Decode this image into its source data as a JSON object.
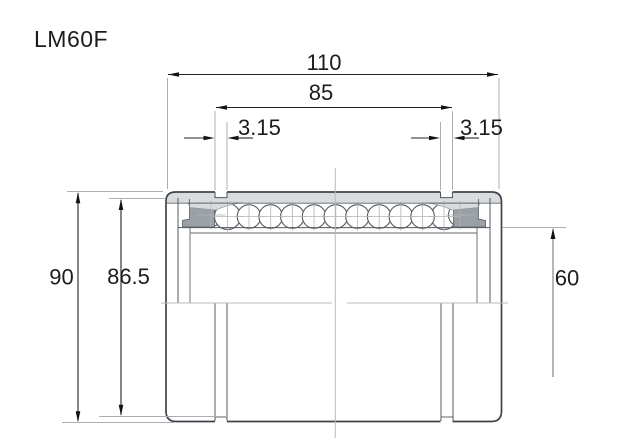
{
  "title": "LM60F",
  "dimensions": {
    "overall_length": "110",
    "groove_span": "85",
    "groove_width_left": "3.15",
    "groove_width_right": "3.15",
    "outer_diameter": "90",
    "groove_diameter": "86.5",
    "bore_diameter": "60"
  },
  "colors": {
    "background": "#ffffff",
    "outline": "#3f444a",
    "shell_fill": "#d9dcde",
    "seal_fill": "#9aa0a6",
    "ball_fill": "#ffffff",
    "dimension_ink": "#1b1c1e",
    "construction_line": "#abafb3"
  },
  "drawing": {
    "view": "cross-section",
    "ball_count": 13
  }
}
